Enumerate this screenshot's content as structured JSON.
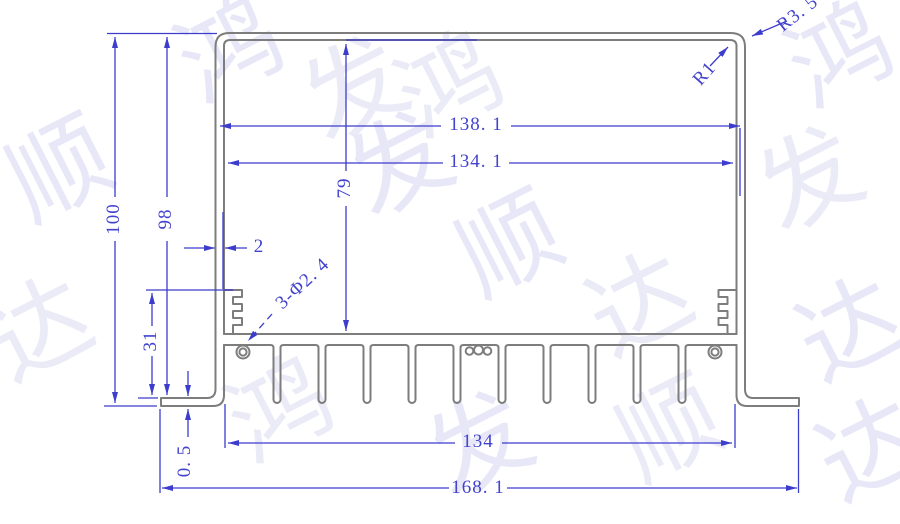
{
  "drawing_title": "heatsink-extrusion-profile-section",
  "dimensions": {
    "height_total": "100",
    "height_to_foot_top": "98",
    "inner_cavity_height": "79",
    "screw_rail_height": "31",
    "foot_thickness": "0. 5",
    "wall_thickness": "2",
    "inner_width_top": "138. 1",
    "inner_width_mid": "134. 1",
    "fin_span_width": "134",
    "total_width": "168. 1",
    "screw_holes_note": "3-Φ2. 4",
    "corner_radius_inner": "R1",
    "corner_radius_outer": "R3. 5"
  },
  "watermark": {
    "company_text": "鸿发顺达",
    "chars": [
      "鸿",
      "发",
      "顺",
      "达"
    ]
  },
  "colors": {
    "dimension_blue": "#3c3ccd",
    "text_blue": "#4343cd",
    "outline_gray": "#7d7d7d",
    "watermark_lavender": "#e7e7f7"
  }
}
